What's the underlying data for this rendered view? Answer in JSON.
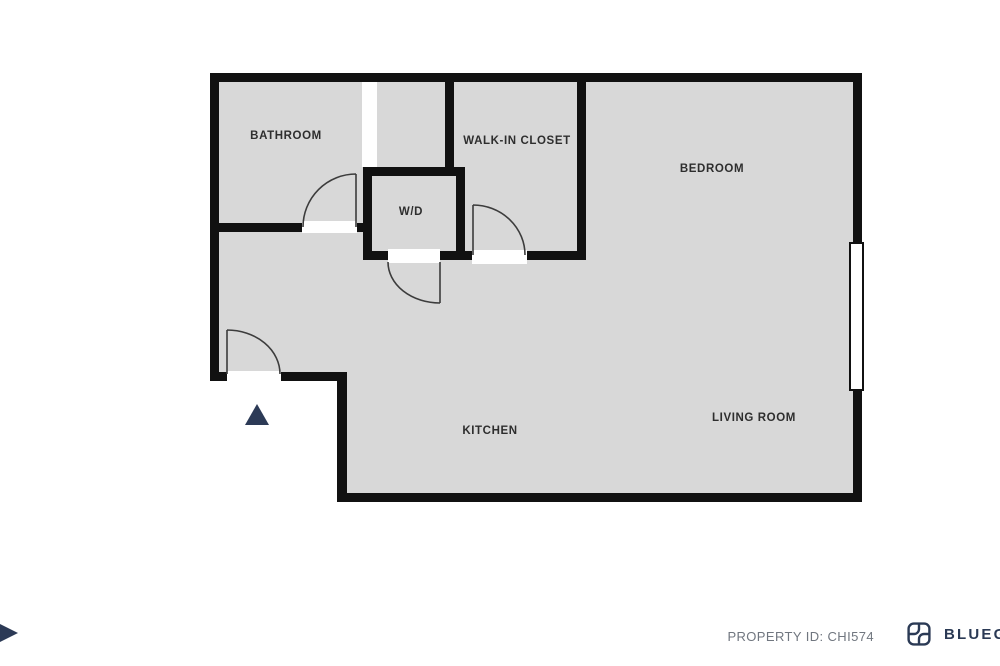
{
  "floorplan": {
    "floor_color": "#d8d8d8",
    "wall_color": "#111111",
    "door_line_color": "#3c3c3c",
    "entry_marker_color": "#2c3a56",
    "rooms": [
      {
        "id": "bathroom",
        "label": "BATHROOM"
      },
      {
        "id": "walk_in_closet",
        "label": "WALK-IN CLOSET"
      },
      {
        "id": "bedroom",
        "label": "BEDROOM"
      },
      {
        "id": "wd",
        "label": "W/D"
      },
      {
        "id": "kitchen",
        "label": "KITCHEN"
      },
      {
        "id": "living_room",
        "label": "LIVING ROOM"
      }
    ]
  },
  "footer": {
    "property_id_label": "PROPERTY ID: CHI574",
    "property_id_color": "#70767f",
    "brand_text": "BLUEG",
    "brand_color": "#2b3a55"
  }
}
